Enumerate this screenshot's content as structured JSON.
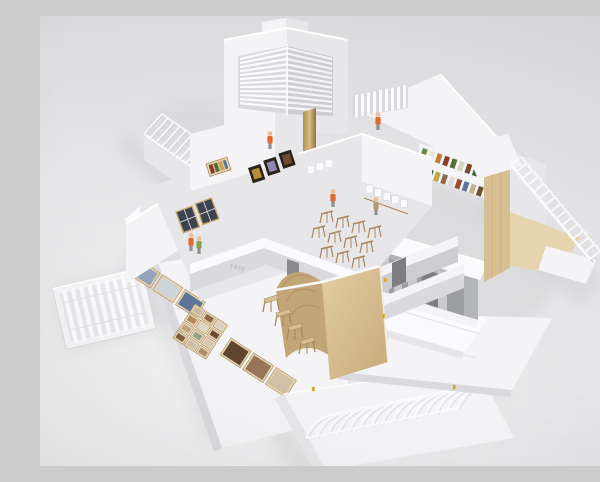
{
  "scene": {
    "type": "photograph",
    "subject": "architectural-scale-model",
    "description": "White card architectural scale model of a gallery building photographed from above on a seamless light-gray studio backdrop. The roofless model shows interior rooms: a central courtyard with rows of tiny wooden easels and miniature figures, side galleries with framed artworks, a plywood barrel-vaulted pavilion with trestle chairs, a corner tower with horizontal louvers, a gray concrete entrance portico with stepped white terraces, detached truss-roof and louver-screen pieces, a skeletal stair truss over timber walls, and a white runway board with small photo collages laid flat.",
    "backdrop": "seamless light-gray studio sweep",
    "wall_stencil": "FREE",
    "elements": [
      {
        "id": "corner-tower-louvers",
        "label": "corner tower with horizontal louver screens"
      },
      {
        "id": "sawtooth-truss-roof",
        "label": "skeletal truss roof over upper-left wing"
      },
      {
        "id": "central-courtyard",
        "label": "courtyard room with wooden easels and figures"
      },
      {
        "id": "gallery-artworks",
        "label": "framed artworks on gallery walls"
      },
      {
        "id": "timber-pavilion",
        "label": "plywood barrel-vault pavilion with trestle chairs"
      },
      {
        "id": "entrance-portico",
        "label": "gray concrete portico with columns and terraces"
      },
      {
        "id": "stair-truss",
        "label": "white skeletal stair truss over timber wall"
      },
      {
        "id": "photo-runway",
        "label": "white runway board with photo collages"
      },
      {
        "id": "louver-panel",
        "label": "detached vertical-slat louver panel"
      },
      {
        "id": "vault-roof-piece",
        "label": "detached ribbed vault roof piece"
      }
    ]
  },
  "palette": {
    "bg1": "#f2f2f3",
    "bg2": "#e6e6e8",
    "bg3": "#d6d6d8",
    "cardBright": "#fbfbfd",
    "cardWhite": "#f4f4f6",
    "cardShade": "#e7e7ea",
    "cardDim": "#dadade",
    "cardDark": "#cdcdd2",
    "shadow": "#a9a9b0",
    "wood": "#d8bf93",
    "woodLight": "#e7d5af",
    "woodDark": "#c3a678",
    "woodLine": "#a9885b",
    "gray1": "#b4b5b8",
    "gray2": "#9d9ea1",
    "gray3": "#c9cacc",
    "grayDark": "#7d7e81",
    "orange": "#e06a2b",
    "green": "#8aa352",
    "tan": "#b59a72",
    "skin": "#e8c19b",
    "legs": "#8f8f94",
    "brass": "#c9a227",
    "brassLight": "#e0c469",
    "artDark": "#2a2118",
    "artGold": "#b78f3a",
    "artPurple": "#9187ae",
    "artBrown": "#6b4c33",
    "glass": "#3c4350"
  },
  "model": {
    "tower_louver_slats": 12,
    "screen_slats": 9,
    "panel_slats": 9,
    "left_truss_ribs": 13,
    "stair_ribs": 14,
    "vault_ribs": 14,
    "easels": [
      [
        287,
        197
      ],
      [
        303,
        202
      ],
      [
        319,
        207
      ],
      [
        335,
        212
      ],
      [
        279,
        212
      ],
      [
        295,
        217
      ],
      [
        311,
        222
      ],
      [
        327,
        227
      ],
      [
        287,
        232
      ],
      [
        303,
        237
      ],
      [
        319,
        242
      ]
    ],
    "chairs": [
      [
        231,
        283
      ],
      [
        243,
        297
      ],
      [
        255,
        311
      ],
      [
        267,
        325
      ]
    ],
    "figures": [
      {
        "x": 151,
        "y": 224,
        "c": "orange"
      },
      {
        "x": 159,
        "y": 227,
        "c": "green"
      },
      {
        "x": 293,
        "y": 180,
        "c": "orange"
      },
      {
        "x": 336,
        "y": 188,
        "c": "tan"
      },
      {
        "x": 230,
        "y": 122,
        "c": "orange"
      },
      {
        "x": 338,
        "y": 103,
        "c": "orange"
      }
    ],
    "hinges": [
      [
        344,
        262
      ],
      [
        272,
        371
      ],
      [
        413,
        369
      ],
      [
        342,
        298
      ]
    ],
    "books_row1": [
      "#6d8a3f",
      "#e8e4da",
      "#c27b3a",
      "#8a3b2a",
      "#5a6e3a",
      "#d9d2c2",
      "#7a4a2a",
      "#44603f"
    ],
    "books_row2": [
      "#3f5d35",
      "#caa24a",
      "#8a6a4a",
      "#e0dbd0",
      "#9a4a30",
      "#5d7596",
      "#c9b08e",
      "#6b4f33"
    ],
    "art_strip": [
      "#b78f3a",
      "#9187ae",
      "#6b4c33"
    ],
    "tiles_c1": [
      "#93a5ba",
      "#cdd4da",
      "#5d7596"
    ],
    "tiles_c2": [
      "#c9b9a2",
      "#8a6a4a",
      "#d9d2c6",
      "#b08a5e",
      "#ddd6ca",
      "#6b4f33",
      "#c2a47e",
      "#93a08a",
      "#d6c8b2",
      "#7d5f42",
      "#cabfae",
      "#a98f6e"
    ],
    "tiles_c3": [
      "#5f4430",
      "#97755a",
      "#d2c0a6"
    ],
    "rail_frames": 5
  }
}
